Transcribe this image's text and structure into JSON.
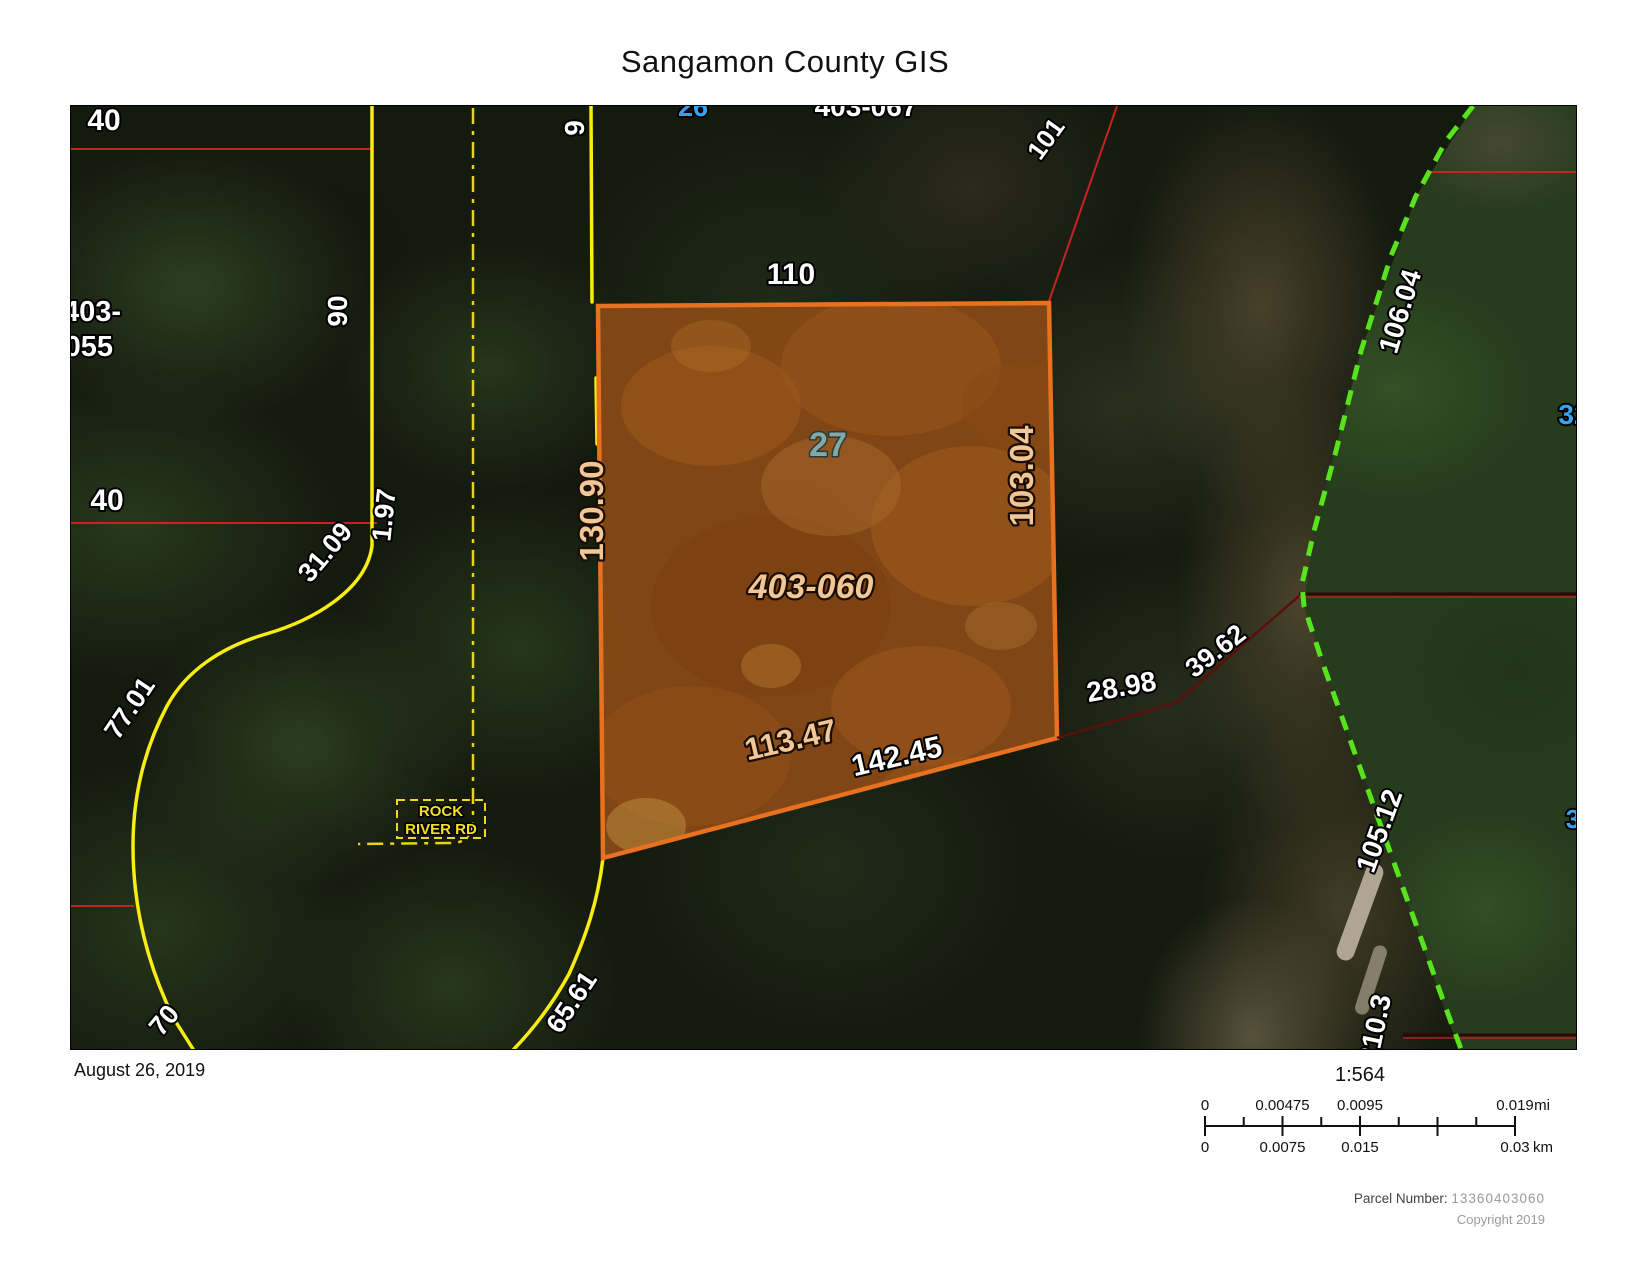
{
  "title": "Sangamon County GIS",
  "footer": {
    "date": "August 26, 2019",
    "scale_ratio": "1:564",
    "parcel_number_label": "Parcel Number:",
    "parcel_number_value": "13360403060",
    "copyright": "Copyright 2019"
  },
  "scale_bar": {
    "mi_ticks": [
      "0",
      "0.00475",
      "0.0095",
      "0.019"
    ],
    "mi_unit": "mi",
    "km_ticks": [
      "0",
      "0.0075",
      "0.015",
      "0.03"
    ],
    "km_unit": "km"
  },
  "map": {
    "highlighted_parcel": {
      "id": "403-060",
      "lot": "27"
    },
    "road_name_line1": "ROCK",
    "road_name_line2": "RIVER RD",
    "labels": {
      "dim_40_upper": "40",
      "parcel_403_055_line1": "403-",
      "parcel_403_055_line2": "055",
      "dim_40_lower": "40",
      "dim_90": "90",
      "dim_9": "9",
      "lot_26": "26",
      "parcel_403_067": "403-067",
      "dim_110": "110",
      "dim_101": "101",
      "dim_31_09": "31.09",
      "dim_1_97": "1.97",
      "dim_77_01": "77.01",
      "dim_70": "70",
      "dim_65_61": "65.61",
      "dim_130_90": "130.90",
      "dim_103_04": "103.04",
      "dim_113_47": "113.47",
      "dim_142_45": "142.45",
      "dim_28_98": "28.98",
      "dim_39_62": "39.62",
      "dim_106_04": "106.04",
      "dim_105_12": "105.12",
      "dim_210": "210.3",
      "lot_32": "32",
      "lot_3": "3"
    },
    "colors": {
      "parcel_fill": "#8a4a16",
      "parcel_border": "#e8711f",
      "road_yellow": "#f7ec13",
      "centerline_yellow": "#e8d416",
      "boundary_green": "#58e41c",
      "line_red": "#c42420",
      "line_dark_red": "#5a100a",
      "dim_white": "#ffffff",
      "dim_tan": "#f2c795",
      "lot_teal": "#84a8a6",
      "lot_blue": "#38a2f0"
    }
  }
}
